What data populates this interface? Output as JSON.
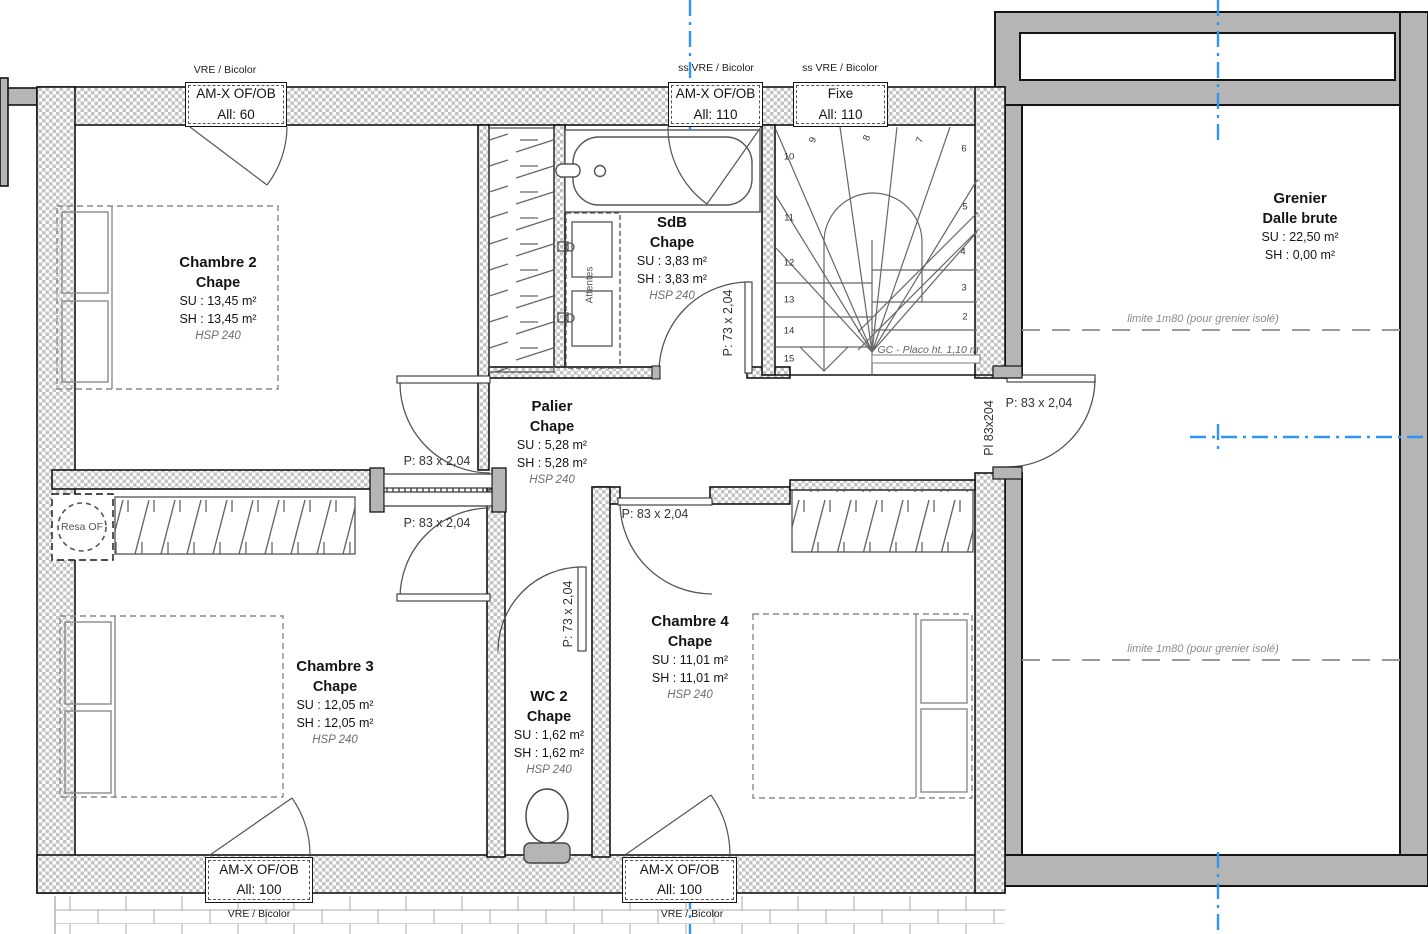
{
  "colors": {
    "wall_gray": "#b5b5b5",
    "wall_checker": "#c3c3c3",
    "outline_black": "#141414",
    "grid_blue": "#2f96f3",
    "furniture_gray": "#8a8a8a",
    "annotation_gray": "#6e6e6e"
  },
  "window_callouts": {
    "top_left": {
      "above": "VRE / Bicolor",
      "line1": "AM-X OF/OB",
      "line2": "All:  60"
    },
    "top_mid": {
      "above": "ss VRE / Bicolor",
      "line1": "AM-X OF/OB",
      "line2": "All:  110"
    },
    "top_fixe": {
      "above": "ss VRE / Bicolor",
      "line1": "Fixe",
      "line2": "All:  110"
    },
    "bottom_left": {
      "below": "VRE / Bicolor",
      "line1": "AM-X OF/OB",
      "line2": "All:  100"
    },
    "bottom_mid": {
      "below": "VRE / Bicolor",
      "line1": "AM-X OF/OB",
      "line2": "All:  100"
    }
  },
  "rooms": {
    "chambre2": {
      "name": "Chambre 2",
      "finish": "Chape",
      "su": "SU : 13,45 m²",
      "sh": "SH : 13,45 m²",
      "hsp": "HSP 240"
    },
    "sdb": {
      "name": "SdB",
      "finish": "Chape",
      "su": "SU : 3,83 m²",
      "sh": "SH : 3,83 m²",
      "hsp": "HSP 240"
    },
    "palier": {
      "name": "Palier",
      "finish": "Chape",
      "su": "SU : 5,28 m²",
      "sh": "SH : 5,28 m²",
      "hsp": "HSP 240"
    },
    "chambre3": {
      "name": "Chambre 3",
      "finish": "Chape",
      "su": "SU : 12,05 m²",
      "sh": "SH : 12,05 m²",
      "hsp": "HSP 240"
    },
    "wc2": {
      "name": "WC 2",
      "finish": "Chape",
      "su": "SU : 1,62 m²",
      "sh": "SH : 1,62 m²",
      "hsp": "HSP 240"
    },
    "chambre4": {
      "name": "Chambre 4",
      "finish": "Chape",
      "su": "SU : 11,01 m²",
      "sh": "SH : 11,01 m²",
      "hsp": "HSP 240"
    },
    "grenier": {
      "name": "Grenier",
      "finish": "Dalle brute",
      "su": "SU : 22,50 m²",
      "sh": "SH : 0,00 m²"
    }
  },
  "doors": {
    "chambre2_door": "P: 83 x 2,04",
    "chambre3_door": "P: 83 x 2,04",
    "chambre4_door": "P: 83 x 2,04",
    "grenier_door": "P: 83 x 2,04",
    "grenier_door_vertical": "Pl 83x204",
    "sdb_door": "P: 73 x 2,04",
    "wc2_door": "P: 73 x 2,04"
  },
  "annotations": {
    "resa_of": "Resa OF",
    "attentes": "Attentes",
    "gc_placo": "GC - Placo ht. 1,10 m",
    "limite_grenier_1": "limite 1m80 (pour grenier isolé)",
    "limite_grenier_2": "limite 1m80 (pour grenier isolé)"
  },
  "stairs": {
    "steps_left": [
      "10",
      "11",
      "12",
      "13",
      "14",
      "15"
    ],
    "steps_top": [
      "9",
      "8",
      "7"
    ],
    "steps_right": [
      "6",
      "5",
      "4",
      "3",
      "2"
    ]
  }
}
